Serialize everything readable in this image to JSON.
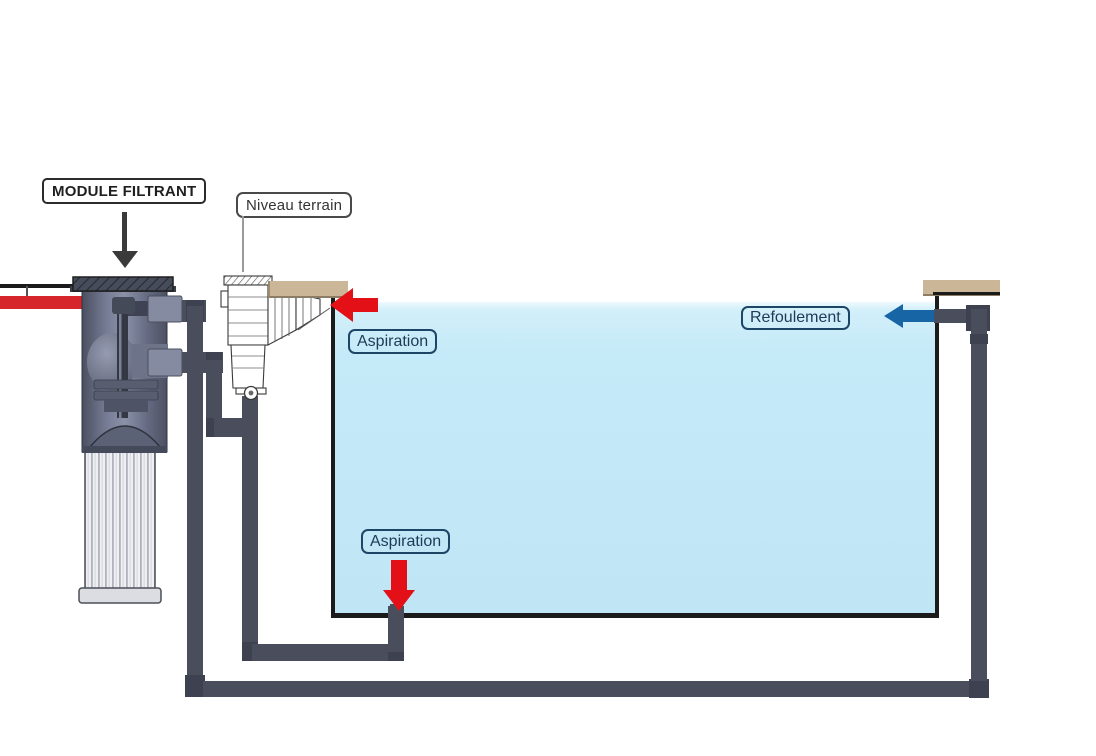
{
  "diagram": {
    "type": "pool-filtration-schematic",
    "callouts": {
      "module_filtrant": "MODULE FILTRANT",
      "niveau_terrain": "Niveau terrain",
      "aspiration_skimmer": "Aspiration",
      "aspiration_drain": "Aspiration",
      "refoulement": "Refoulement"
    },
    "arrows": {
      "skimmer_suction": {
        "direction": "left",
        "color": "#e31117"
      },
      "drain_suction": {
        "direction": "down",
        "color": "#e31117"
      },
      "return_flow": {
        "direction": "left",
        "color": "#1865a5"
      }
    },
    "colors": {
      "water": "#c3e9f8",
      "pipe": "#4a4e5c",
      "pipe_elbow": "#3e4250",
      "supply_pipe_red": "#d6252b",
      "coping_tan": "#cbb697",
      "wall_black": "#1b1b1b",
      "label_navy": "#1d3a57"
    }
  }
}
